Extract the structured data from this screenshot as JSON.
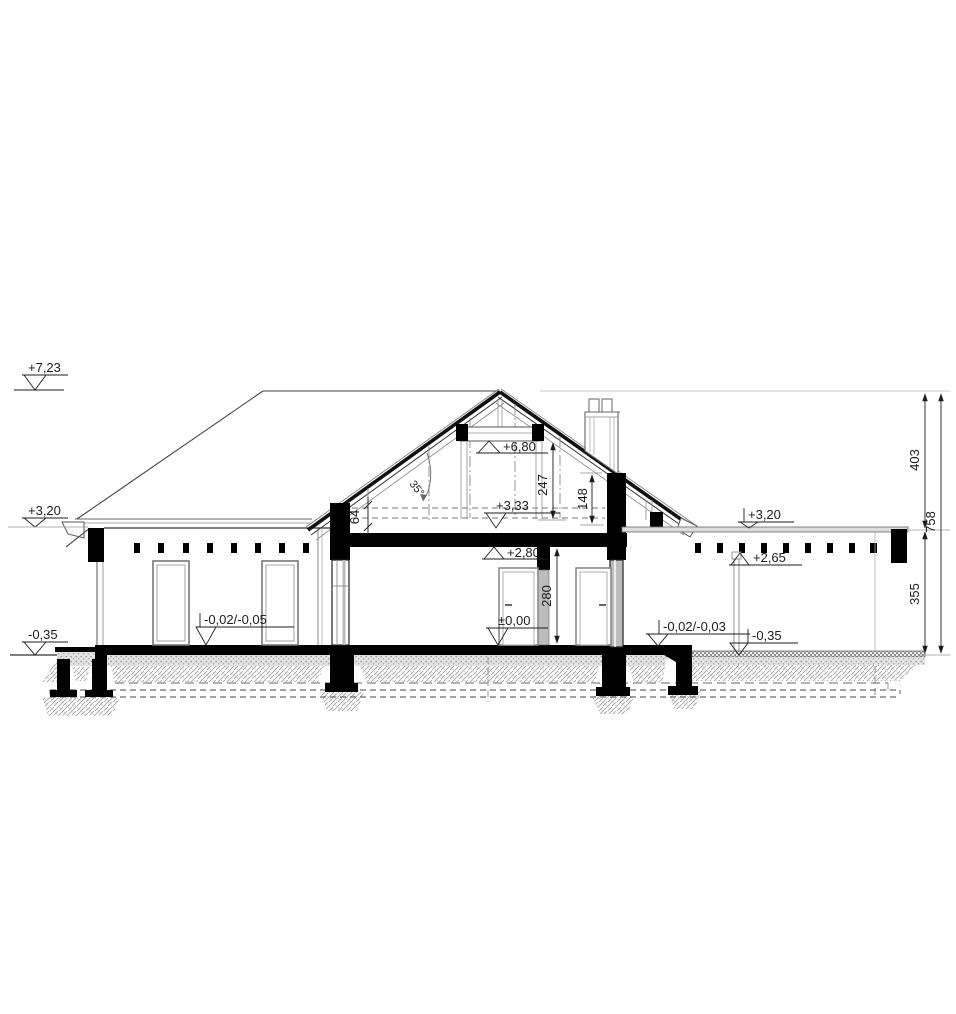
{
  "drawing": {
    "type": "architectural-cross-section",
    "levels": {
      "ridge": "+7,23",
      "eave_left": "+3,20",
      "terrain_left": "-0,35",
      "floor_left": "-0,02/-0,05",
      "collar": "+6,80",
      "attic_floor": "+3,33",
      "ceiling": "+2,80",
      "ground_floor": "±0,00",
      "eave_right": "+3,20",
      "post_top": "+2,65",
      "floor_right": "-0,02/-0,03",
      "terrain_right": "-0,35"
    },
    "dimensions": {
      "roof_angle": "35°",
      "attic_clear_height": "247",
      "knee_wall_right": "148",
      "attic_floor_buildup": "64",
      "room_height": "280",
      "roof_zone_height": "403",
      "wall_zone_height": "355",
      "total_height": "758"
    },
    "colors": {
      "line": "#1c1c1c",
      "cut_fill": "#000000",
      "medium": "#555555",
      "light": "#8a8a8a",
      "glazing_gray": "#bcbcbc",
      "hatch": "#9e9e9e",
      "stipple": "#a8a8a8"
    }
  }
}
